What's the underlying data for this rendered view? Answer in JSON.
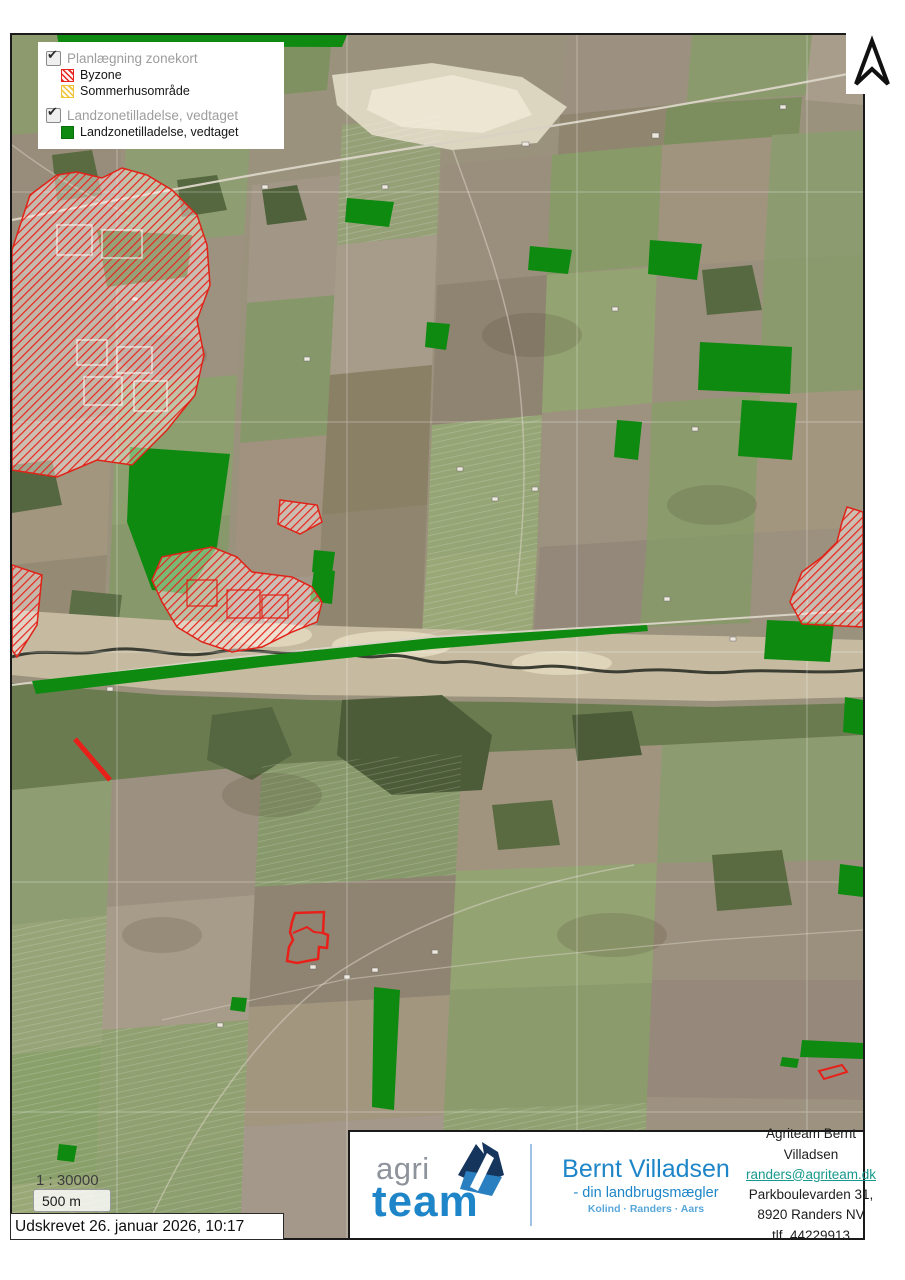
{
  "legend": {
    "groups": [
      {
        "label": "Planlægning zonekort",
        "checked": true,
        "items": [
          {
            "label": "Byzone",
            "swatch": "red-hatch",
            "color": "#e8251d"
          },
          {
            "label": "Sommerhusområde",
            "swatch": "yellow-hatch",
            "color": "#eec43a"
          }
        ]
      },
      {
        "label": "Landzonetilladelse, vedtaget",
        "checked": true,
        "items": [
          {
            "label": "Landzonetilladelse, vedtaget",
            "swatch": "green-solid",
            "color": "#0e8a10"
          }
        ]
      }
    ]
  },
  "scale": {
    "ratio_text": "1 : 30000",
    "bar_label": "500 m"
  },
  "printed": {
    "text": "Udskrevet 26. januar 2026, 10:17"
  },
  "footer": {
    "logo": {
      "word1": "agri",
      "word2": "team"
    },
    "brand": {
      "name": "Bernt Villadsen",
      "tagline": "- din landbrugsmægler",
      "cities": "Kolind · Randers · Aars"
    },
    "contact": {
      "line1": "Agriteam Bernt Villadsen",
      "email": "randers@agriteam.dk",
      "line3": "Parkboulevarden 31,",
      "line4": "8920 Randers NV",
      "line5": "tlf. 44229913"
    }
  },
  "map": {
    "colors": {
      "byzone": "#e8251d",
      "sommerhusomraade": "#eec43a",
      "landzonetilladelse": "#0e8a10"
    }
  }
}
